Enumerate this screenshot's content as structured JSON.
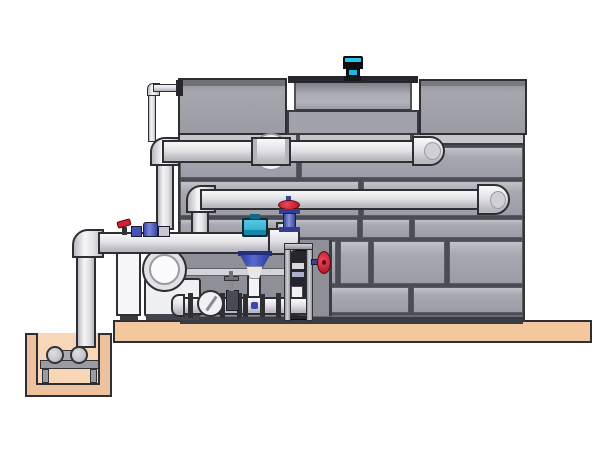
{
  "scene": {
    "type": "technical-illustration",
    "subject": "closed-circuit cooling tower with fan motor, external piping, pump skid, valve rack and sump pit",
    "visible_text": "none",
    "components": [
      "cooling-tower-casing",
      "fan-shroud",
      "fan-motor",
      "tower-panels",
      "upper-supply-pipe",
      "middle-return-pipe",
      "main-suction-pipe",
      "lower-manifold-pipe",
      "equalizer-thin-pipe",
      "pipe-coupling-disc",
      "control-valve-actuator",
      "control-valve-bell",
      "gate-valve-red-handwheel",
      "side-gate-valve-red-handwheel",
      "small-drain-valve",
      "check-valve-disc",
      "ball-valve-red-lever",
      "dosing-fittings-blue",
      "inline-pump-volute",
      "control-cabinet",
      "valve-rack",
      "concrete-slab",
      "sump-pit",
      "sump-pump-set"
    ]
  },
  "colors": {
    "panel": "#a8a8b1",
    "panel-hi": "#c2c2c9",
    "panel2": "#9b9ba4",
    "seam": "#4c4c55",
    "outline": "#2e2e34",
    "strip": "#c6c6cc",
    "base-strip": "#3b3b42",
    "pipe-hi": "#f6f6f8",
    "pipe-mid": "#e2e2e6",
    "pipe-lo": "#b9b9c0",
    "white": "#f7f7f9",
    "slab": "#f4c89e",
    "pit-wall": "#edc19c",
    "pit-inner": "#f7d7b8",
    "cyan": "#2bc4e4",
    "cyan-dk": "#1586a8",
    "blue": "#3a48a8",
    "blue-hi": "#8a94dc",
    "blue-dk": "#23307e",
    "red": "#d22030",
    "red-dk": "#550a12",
    "metal": "#cfcfd5",
    "dark": "#26262c",
    "dark2": "#2f2f36",
    "bay": "#8f8f98",
    "rack-dark": "#26262d"
  }
}
